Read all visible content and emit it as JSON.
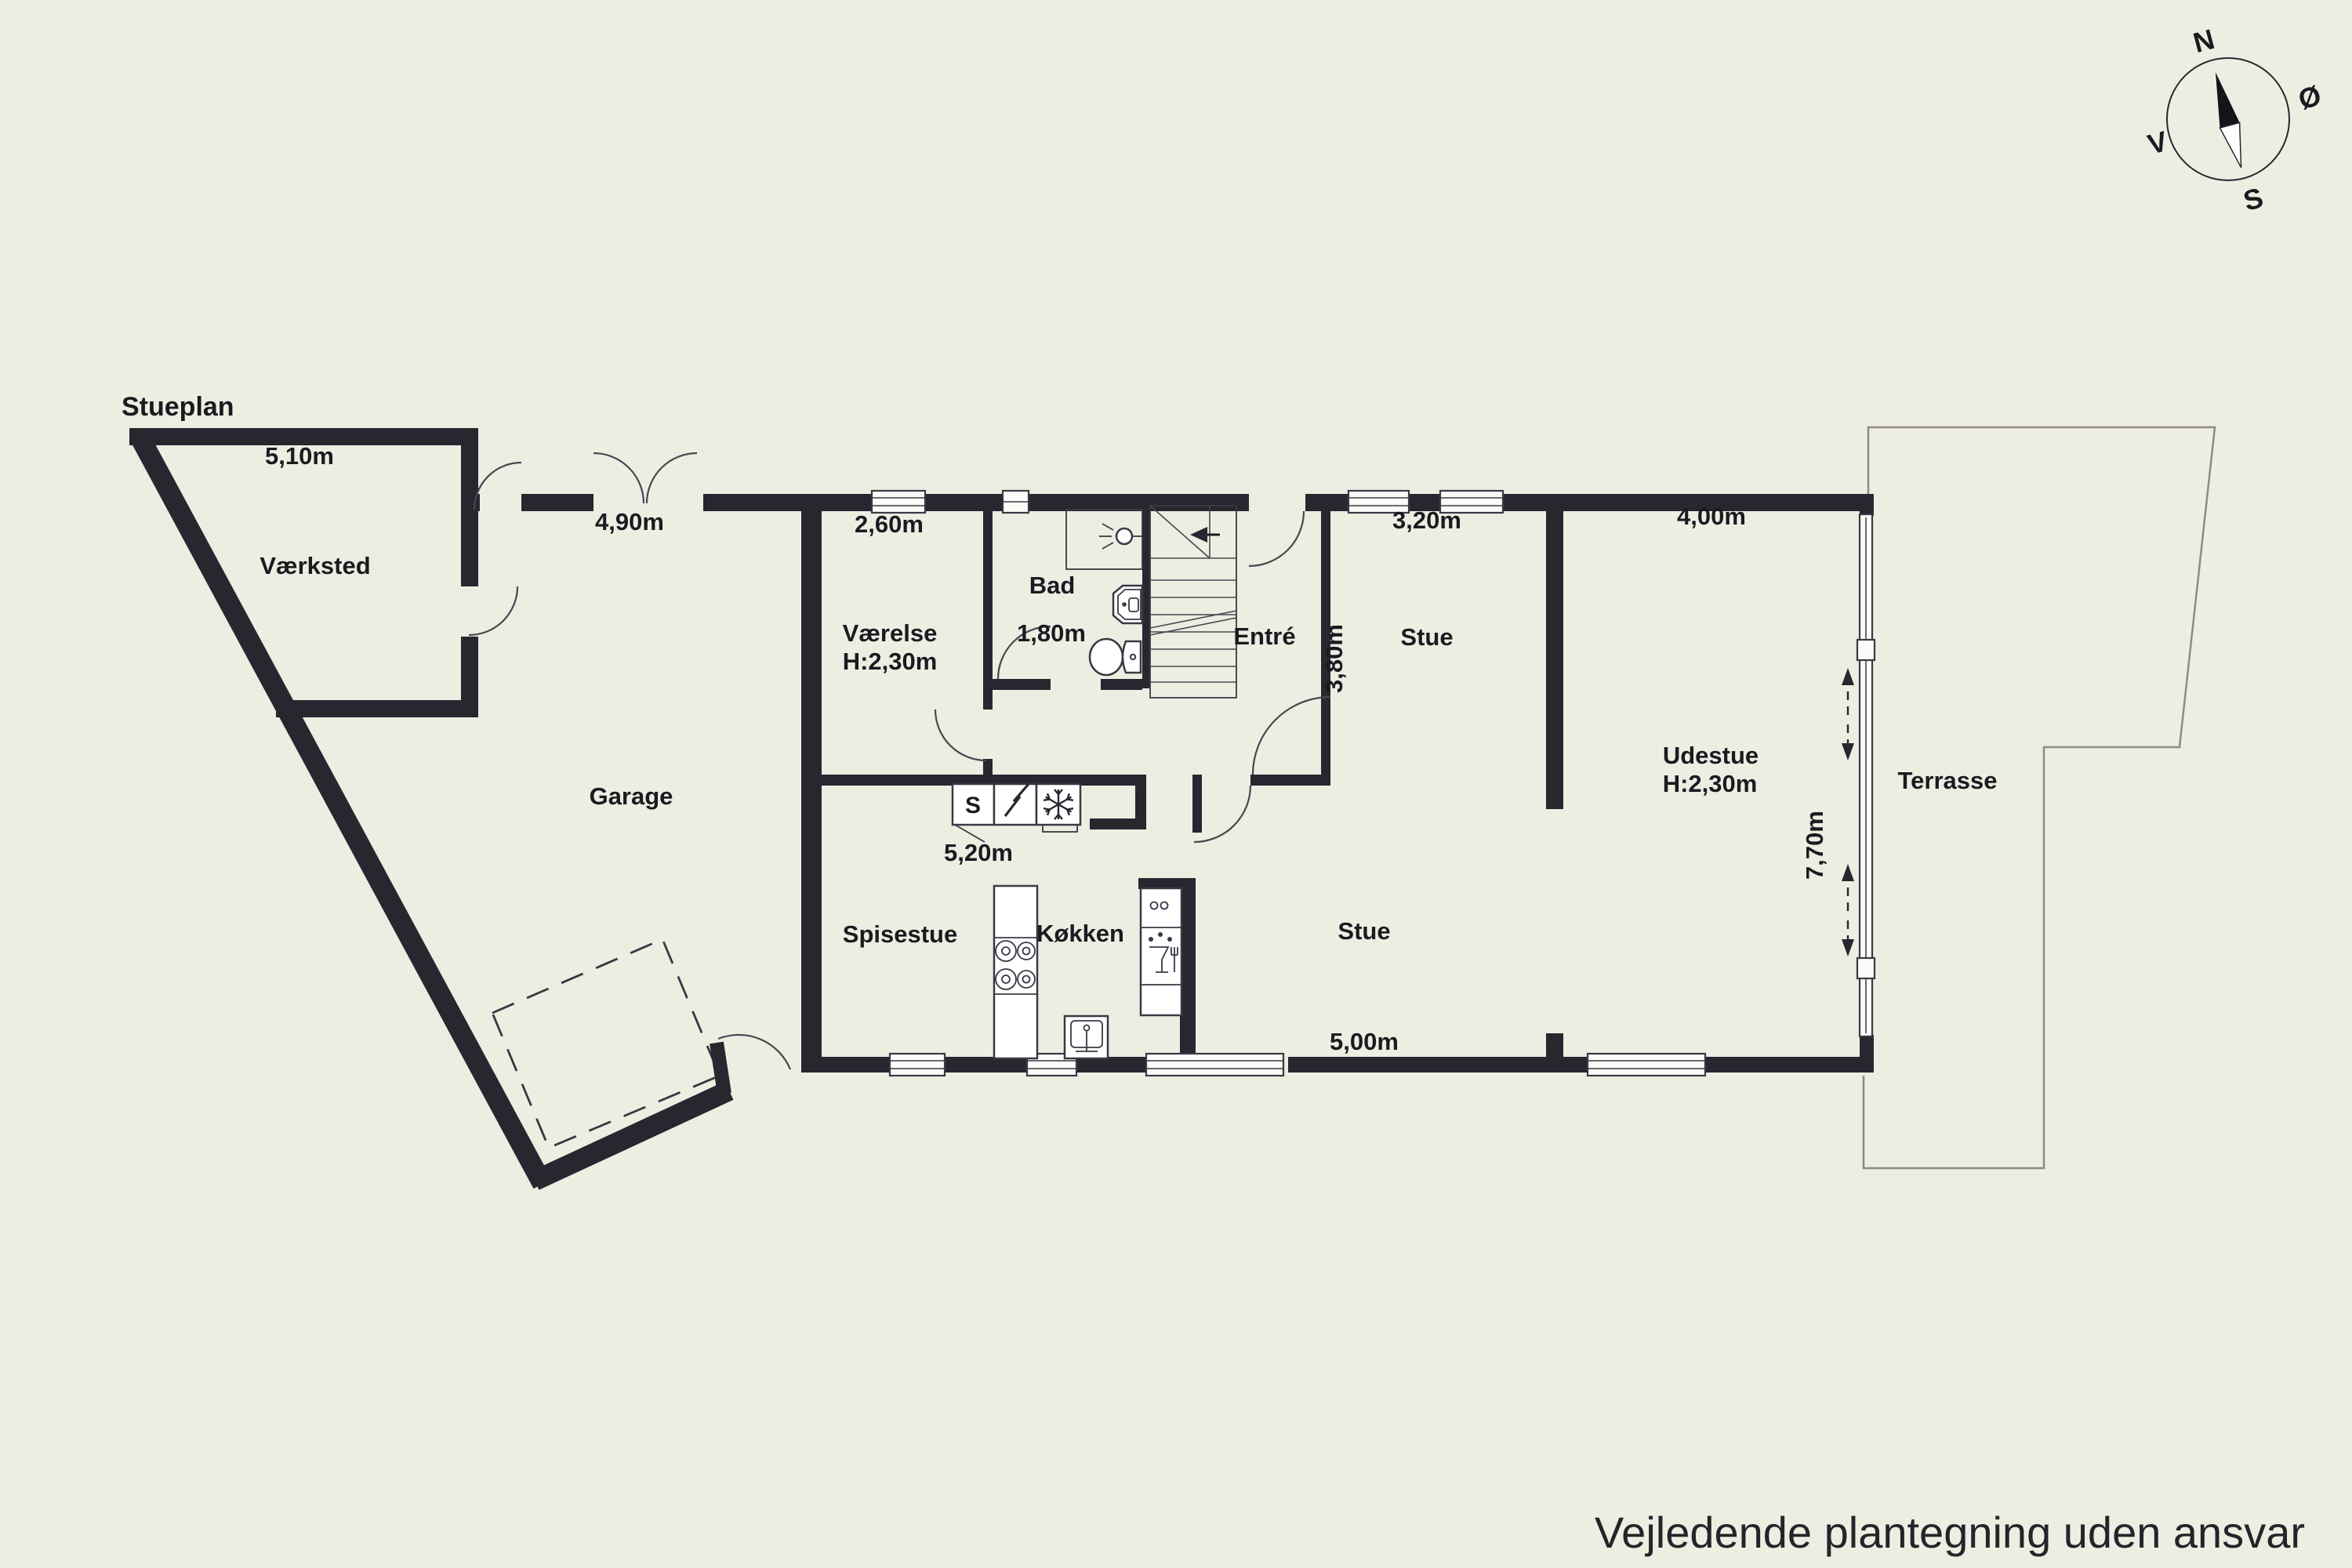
{
  "title": "Stueplan",
  "disclaimer": "Vejledende plantegning uden ansvar",
  "compass": {
    "north": "N",
    "east": "Ø",
    "south": "S",
    "west": "V"
  },
  "rooms": {
    "vaerksted": {
      "label": "Værksted",
      "width": "5,10m"
    },
    "garage": {
      "label": "Garage",
      "width": "4,90m"
    },
    "vaerelse": {
      "label": "Værelse",
      "ceiling": "H:2,30m",
      "width": "2,60m"
    },
    "bad": {
      "label": "Bad",
      "width": "1,80m"
    },
    "entre": {
      "label": "Entré"
    },
    "stue_upper": {
      "label": "Stue",
      "width": "3,20m",
      "depth": "3,80m"
    },
    "udestue": {
      "label": "Udestue",
      "ceiling": "H:2,30m",
      "width": "4,00m",
      "depth": "7,70m"
    },
    "terrasse": {
      "label": "Terrasse"
    },
    "spisestue": {
      "label": "Spisestue",
      "width": "5,20m"
    },
    "koekken": {
      "label": "Køkken"
    },
    "stue_lower": {
      "label": "Stue",
      "width": "5,00m"
    }
  },
  "appliances": {
    "storage": "S"
  },
  "icons": [
    "compass-rose-icon",
    "shower-icon",
    "sink-icon",
    "toilet-icon",
    "stove-icon",
    "kitchen-sink-icon",
    "dishwasher-icon",
    "electric-icon",
    "freezer-icon",
    "sliding-door-arrows-icon"
  ],
  "colors": {
    "background": "#eeede2",
    "wall": "#2a2630",
    "text": "#1c1a20",
    "fixture_line": "#3c3845",
    "site_line": "#8d8c80"
  }
}
